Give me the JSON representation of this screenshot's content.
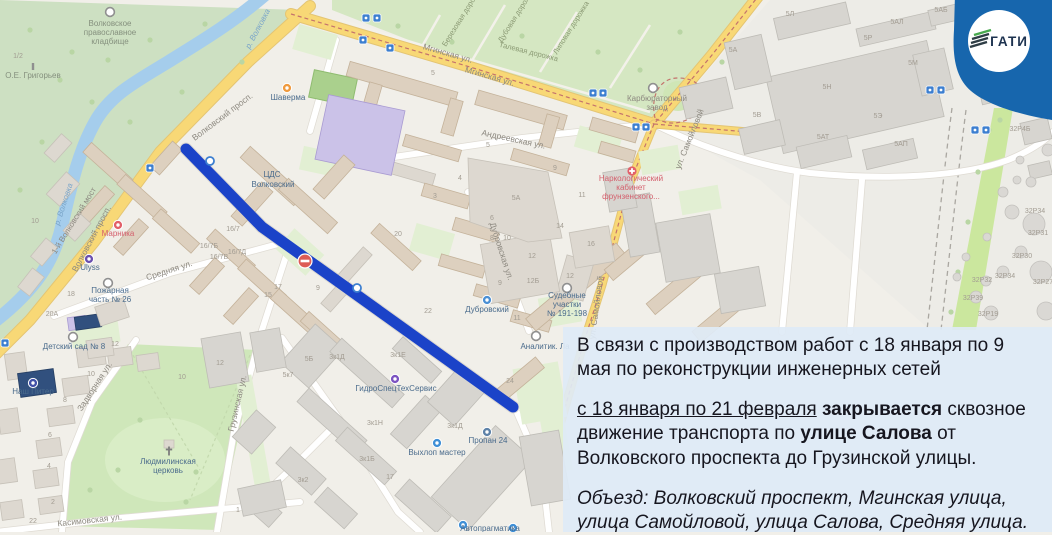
{
  "badge": {
    "logo_text": "ГАТИ",
    "badge_color": "#1766ad",
    "logo_text_color": "#1e3350",
    "logo_accent_green": "#48a94e"
  },
  "closure": {
    "line_color": "#1b43c8",
    "no_entry_sign": "no-entry"
  },
  "overlay": {
    "paragraphs": [
      {
        "segments": [
          {
            "t": "В связи с производством работ с 18 января по 9 мая по реконструкции инженерных сетей"
          }
        ]
      },
      {
        "segments": [
          {
            "t": "с 18 января по 21 февраля",
            "u": true
          },
          {
            "t": " "
          },
          {
            "t": "закрывается",
            "b": true
          },
          {
            "t": " сквозное движение транспорта по "
          },
          {
            "t": "улице Салова",
            "b": true
          },
          {
            "t": " от Волковского проспекта до Грузинской улицы."
          }
        ]
      },
      {
        "italic": true,
        "segments": [
          {
            "t": "Объезд: Волковский проспект, Мгинская улица, улица Самойловой, улица Салова, Средняя улица."
          }
        ]
      }
    ]
  },
  "map": {
    "labels": [
      {
        "t": "Волковское",
        "x": 110,
        "y": 26,
        "cls": "ce"
      },
      {
        "t": "православное",
        "x": 110,
        "y": 35,
        "cls": "ce"
      },
      {
        "t": "кладбище",
        "x": 110,
        "y": 44,
        "cls": "ce"
      },
      {
        "t": "О.Е. Григорьев",
        "x": 33,
        "y": 78,
        "cls": "ce"
      },
      {
        "t": "р. Волковка",
        "x": 260,
        "y": 30,
        "r": -62,
        "cls": "wa"
      },
      {
        "t": "р. Волковка",
        "x": 66,
        "y": 205,
        "r": -72,
        "cls": "wa"
      },
      {
        "t": "1-й Волковский мост",
        "x": 76,
        "y": 222,
        "r": -58,
        "cls": "pl"
      },
      {
        "t": "Волковский просп.",
        "x": 224,
        "y": 119,
        "r": -37,
        "cls": "st"
      },
      {
        "t": "Волковский просп.",
        "x": 94,
        "y": 240,
        "r": -62,
        "cls": "st"
      },
      {
        "t": "Мгинская ул.",
        "x": 447,
        "y": 56,
        "r": 16,
        "cls": "st"
      },
      {
        "t": "Мгинская ул.",
        "x": 489,
        "y": 79,
        "r": 16,
        "cls": "st"
      },
      {
        "t": "Березовая дорожка",
        "x": 464,
        "y": 18,
        "r": -58,
        "cls": "pa"
      },
      {
        "t": "Дубовая дорожка",
        "x": 518,
        "y": 17,
        "r": -58,
        "cls": "pa"
      },
      {
        "t": "Липовая дорожка",
        "x": 573,
        "y": 29,
        "r": -58,
        "cls": "pa"
      },
      {
        "t": "Талевая дорожка",
        "x": 528,
        "y": 54,
        "r": 14,
        "cls": "pa"
      },
      {
        "t": "Андреевская ул.",
        "x": 513,
        "y": 142,
        "r": 12,
        "cls": "st"
      },
      {
        "t": "ул. Самойловой",
        "x": 692,
        "y": 140,
        "r": -68,
        "cls": "st"
      },
      {
        "t": "ул. Самойловой",
        "x": 599,
        "y": 308,
        "r": -82,
        "cls": "st"
      },
      {
        "t": "Карбюраторный",
        "x": 657,
        "y": 101,
        "cls": "pl"
      },
      {
        "t": "завод",
        "x": 657,
        "y": 110,
        "cls": "pl"
      },
      {
        "t": "Дубровская ул.",
        "x": 499,
        "y": 252,
        "r": 72,
        "cls": "st"
      },
      {
        "t": "Средняя ул.",
        "x": 170,
        "y": 273,
        "r": -18,
        "cls": "st"
      },
      {
        "t": "Грузинская ул.",
        "x": 240,
        "y": 404,
        "r": -77,
        "cls": "st"
      },
      {
        "t": "Задворная ул.",
        "x": 97,
        "y": 388,
        "r": -57,
        "cls": "st"
      },
      {
        "t": "Касимовская ул.",
        "x": 90,
        "y": 523,
        "r": -6,
        "cls": "st"
      },
      {
        "t": "ЦДС",
        "x": 272,
        "y": 177,
        "cls": "poi"
      },
      {
        "t": "Волковский",
        "x": 273,
        "y": 187,
        "cls": "poi"
      },
      {
        "t": "Шаверма",
        "x": 288,
        "y": 100,
        "cls": "poi"
      },
      {
        "t": "Марника",
        "x": 118,
        "y": 236,
        "cls": "poired"
      },
      {
        "t": "Ulyss",
        "x": 90,
        "y": 270,
        "cls": "poi"
      },
      {
        "t": "Наш Питер",
        "x": 33,
        "y": 394,
        "cls": "poi"
      },
      {
        "t": "Пожарная",
        "x": 110,
        "y": 293,
        "cls": "poi"
      },
      {
        "t": "часть № 26",
        "x": 110,
        "y": 302,
        "cls": "poi"
      },
      {
        "t": "Детский сад № 8",
        "x": 74,
        "y": 349,
        "cls": "poi"
      },
      {
        "t": "Людмилинская",
        "x": 168,
        "y": 464,
        "cls": "poi"
      },
      {
        "t": "церковь",
        "x": 168,
        "y": 473,
        "cls": "poi"
      },
      {
        "t": "Дубровский",
        "x": 487,
        "y": 312,
        "cls": "poi"
      },
      {
        "t": "ГидроСпецТехСервис",
        "x": 396,
        "y": 391,
        "cls": "poi"
      },
      {
        "t": "Выхлоп мастер",
        "x": 437,
        "y": 455,
        "cls": "poi"
      },
      {
        "t": "Пропан 24",
        "x": 488,
        "y": 443,
        "cls": "poi"
      },
      {
        "t": "Судебные",
        "x": 567,
        "y": 298,
        "cls": "poi"
      },
      {
        "t": "участки",
        "x": 567,
        "y": 307,
        "cls": "poi"
      },
      {
        "t": "№ 191-198",
        "x": 567,
        "y": 316,
        "cls": "poi"
      },
      {
        "t": "Аналитик. Ла",
        "x": 545,
        "y": 349,
        "cls": "poi"
      },
      {
        "t": "Наркологический",
        "x": 631,
        "y": 181,
        "cls": "poired"
      },
      {
        "t": "кабинет",
        "x": 631,
        "y": 190,
        "cls": "poired"
      },
      {
        "t": "фрунзенского...",
        "x": 631,
        "y": 199,
        "cls": "poired"
      },
      {
        "t": "Автопрагматика",
        "x": 490,
        "y": 531,
        "cls": "poi"
      },
      {
        "t": "5Л",
        "x": 790,
        "y": 16,
        "cls": "num"
      },
      {
        "t": "5АЛ",
        "x": 897,
        "y": 24,
        "cls": "num"
      },
      {
        "t": "5АБ",
        "x": 941,
        "y": 12,
        "cls": "num"
      },
      {
        "t": "5Р",
        "x": 868,
        "y": 40,
        "cls": "num"
      },
      {
        "t": "5Н",
        "x": 827,
        "y": 89,
        "cls": "num"
      },
      {
        "t": "5М",
        "x": 913,
        "y": 65,
        "cls": "num"
      },
      {
        "t": "5Э",
        "x": 878,
        "y": 118,
        "cls": "num"
      },
      {
        "t": "5АТ",
        "x": 823,
        "y": 139,
        "cls": "num"
      },
      {
        "t": "5АП",
        "x": 901,
        "y": 146,
        "cls": "num"
      },
      {
        "t": "5В",
        "x": 757,
        "y": 117,
        "cls": "num"
      },
      {
        "t": "32Р4Б",
        "x": 1020,
        "y": 131,
        "cls": "num"
      },
      {
        "t": "32Р34",
        "x": 1035,
        "y": 213,
        "cls": "num"
      },
      {
        "t": "32Р31",
        "x": 1038,
        "y": 235,
        "cls": "num"
      },
      {
        "t": "32Р30",
        "x": 1022,
        "y": 258,
        "cls": "num"
      },
      {
        "t": "32Р34",
        "x": 1005,
        "y": 278,
        "cls": "num"
      },
      {
        "t": "32Р27",
        "x": 1043,
        "y": 284,
        "cls": "num"
      },
      {
        "t": "32Р32",
        "x": 982,
        "y": 282,
        "cls": "num"
      },
      {
        "t": "32Р39",
        "x": 973,
        "y": 300,
        "cls": "num"
      },
      {
        "t": "32Р19",
        "x": 988,
        "y": 316,
        "cls": "num"
      },
      {
        "t": "16/7",
        "x": 233,
        "y": 231,
        "cls": "num"
      },
      {
        "t": "16/7Б",
        "x": 209,
        "y": 248,
        "cls": "num"
      },
      {
        "t": "16/7Д",
        "x": 237,
        "y": 254,
        "cls": "num"
      },
      {
        "t": "16/7В",
        "x": 219,
        "y": 259,
        "cls": "num"
      },
      {
        "t": "17",
        "x": 278,
        "y": 289,
        "cls": "num"
      },
      {
        "t": "15",
        "x": 268,
        "y": 297,
        "cls": "num"
      },
      {
        "t": "9",
        "x": 318,
        "y": 290,
        "cls": "num"
      },
      {
        "t": "20",
        "x": 398,
        "y": 236,
        "cls": "num"
      },
      {
        "t": "24",
        "x": 510,
        "y": 383,
        "cls": "num"
      },
      {
        "t": "14",
        "x": 560,
        "y": 228,
        "cls": "num"
      },
      {
        "t": "16",
        "x": 591,
        "y": 246,
        "cls": "num"
      },
      {
        "t": "12",
        "x": 570,
        "y": 278,
        "cls": "num"
      },
      {
        "t": "12Б",
        "x": 533,
        "y": 283,
        "cls": "num"
      },
      {
        "t": "11",
        "x": 582,
        "y": 197,
        "cls": "num"
      },
      {
        "t": "9",
        "x": 555,
        "y": 170,
        "cls": "num"
      },
      {
        "t": "5",
        "x": 488,
        "y": 147,
        "cls": "num"
      },
      {
        "t": "3",
        "x": 435,
        "y": 198,
        "cls": "num"
      },
      {
        "t": "4",
        "x": 460,
        "y": 180,
        "cls": "num"
      },
      {
        "t": "6",
        "x": 492,
        "y": 220,
        "cls": "num"
      },
      {
        "t": "8",
        "x": 492,
        "y": 240,
        "cls": "num"
      },
      {
        "t": "10",
        "x": 507,
        "y": 240,
        "cls": "num"
      },
      {
        "t": "12",
        "x": 532,
        "y": 258,
        "cls": "num"
      },
      {
        "t": "9",
        "x": 500,
        "y": 285,
        "cls": "num"
      },
      {
        "t": "22",
        "x": 428,
        "y": 313,
        "cls": "num"
      },
      {
        "t": "11",
        "x": 517,
        "y": 320,
        "cls": "num"
      },
      {
        "t": "5",
        "x": 433,
        "y": 75,
        "cls": "num"
      },
      {
        "t": "1/2",
        "x": 18,
        "y": 58,
        "cls": "num"
      },
      {
        "t": "10",
        "x": 35,
        "y": 223,
        "cls": "num"
      },
      {
        "t": "18",
        "x": 71,
        "y": 296,
        "cls": "num"
      },
      {
        "t": "20А",
        "x": 52,
        "y": 316,
        "cls": "num"
      },
      {
        "t": "12",
        "x": 115,
        "y": 346,
        "cls": "num"
      },
      {
        "t": "10",
        "x": 182,
        "y": 379,
        "cls": "num"
      },
      {
        "t": "10",
        "x": 91,
        "y": 376,
        "cls": "num"
      },
      {
        "t": "8",
        "x": 65,
        "y": 402,
        "cls": "num"
      },
      {
        "t": "6",
        "x": 50,
        "y": 437,
        "cls": "num"
      },
      {
        "t": "4",
        "x": 49,
        "y": 468,
        "cls": "num"
      },
      {
        "t": "2",
        "x": 53,
        "y": 504,
        "cls": "num"
      },
      {
        "t": "22",
        "x": 33,
        "y": 523,
        "cls": "num"
      },
      {
        "t": "12",
        "x": 220,
        "y": 365,
        "cls": "num"
      },
      {
        "t": "1",
        "x": 238,
        "y": 512,
        "cls": "num"
      },
      {
        "t": "5Б",
        "x": 309,
        "y": 361,
        "cls": "num"
      },
      {
        "t": "5к7",
        "x": 288,
        "y": 377,
        "cls": "num"
      },
      {
        "t": "3к1Д",
        "x": 337,
        "y": 359,
        "cls": "num"
      },
      {
        "t": "3к1Е",
        "x": 398,
        "y": 357,
        "cls": "num"
      },
      {
        "t": "3к1Н",
        "x": 375,
        "y": 425,
        "cls": "num"
      },
      {
        "t": "3к1Д",
        "x": 455,
        "y": 428,
        "cls": "num"
      },
      {
        "t": "3к1Б",
        "x": 367,
        "y": 461,
        "cls": "num"
      },
      {
        "t": "3к2",
        "x": 303,
        "y": 482,
        "cls": "num"
      },
      {
        "t": "17",
        "x": 390,
        "y": 479,
        "cls": "num"
      },
      {
        "t": "5А",
        "x": 516,
        "y": 200,
        "cls": "num"
      },
      {
        "t": "5А",
        "x": 733,
        "y": 52,
        "cls": "num"
      }
    ],
    "icons": [
      {
        "k": "ring",
        "x": 110,
        "y": 12
      },
      {
        "k": "ring",
        "x": 653,
        "y": 88
      },
      {
        "k": "ring",
        "x": 108,
        "y": 283
      },
      {
        "k": "ring",
        "x": 73,
        "y": 337
      },
      {
        "k": "ring",
        "x": 567,
        "y": 288
      },
      {
        "k": "ring",
        "x": 536,
        "y": 336
      },
      {
        "k": "dot",
        "x": 287,
        "y": 88,
        "c": "#ef9a3e"
      },
      {
        "k": "dot",
        "x": 118,
        "y": 225,
        "c": "#e25f68"
      },
      {
        "k": "dot",
        "x": 89,
        "y": 259,
        "c": "#6a4fae"
      },
      {
        "k": "dot",
        "x": 33,
        "y": 383,
        "c": "#4050a8"
      },
      {
        "k": "dot",
        "x": 487,
        "y": 300,
        "c": "#4a8fd4"
      },
      {
        "k": "dot",
        "x": 395,
        "y": 379,
        "c": "#7b52c1"
      },
      {
        "k": "dot",
        "x": 437,
        "y": 443,
        "c": "#3f8fd6"
      },
      {
        "k": "dot",
        "x": 487,
        "y": 432,
        "c": "#5e82a8"
      },
      {
        "k": "dot",
        "x": 463,
        "y": 525,
        "c": "#3f8fd6"
      },
      {
        "k": "dot",
        "x": 513,
        "y": 528,
        "c": "#3f8fd6"
      },
      {
        "k": "sq",
        "x": 366,
        "y": 18
      },
      {
        "k": "sq",
        "x": 377,
        "y": 18
      },
      {
        "k": "sq",
        "x": 363,
        "y": 40
      },
      {
        "k": "sq",
        "x": 390,
        "y": 48
      },
      {
        "k": "sq",
        "x": 593,
        "y": 93
      },
      {
        "k": "sq",
        "x": 603,
        "y": 93
      },
      {
        "k": "sq",
        "x": 636,
        "y": 127
      },
      {
        "k": "sq",
        "x": 646,
        "y": 127
      },
      {
        "k": "sq",
        "x": 930,
        "y": 90
      },
      {
        "k": "sq",
        "x": 941,
        "y": 90
      },
      {
        "k": "sq",
        "x": 975,
        "y": 130
      },
      {
        "k": "sq",
        "x": 986,
        "y": 130
      },
      {
        "k": "sq",
        "x": 150,
        "y": 168
      },
      {
        "k": "sq",
        "x": 5,
        "y": 343
      },
      {
        "k": "ringb",
        "x": 210,
        "y": 161
      },
      {
        "k": "ringb",
        "x": 357,
        "y": 288
      },
      {
        "k": "med",
        "x": 632,
        "y": 171
      },
      {
        "k": "cross",
        "x": 169,
        "y": 451
      },
      {
        "k": "mon",
        "x": 33,
        "y": 67
      },
      {
        "k": "noentry",
        "x": 305,
        "y": 261
      }
    ]
  }
}
